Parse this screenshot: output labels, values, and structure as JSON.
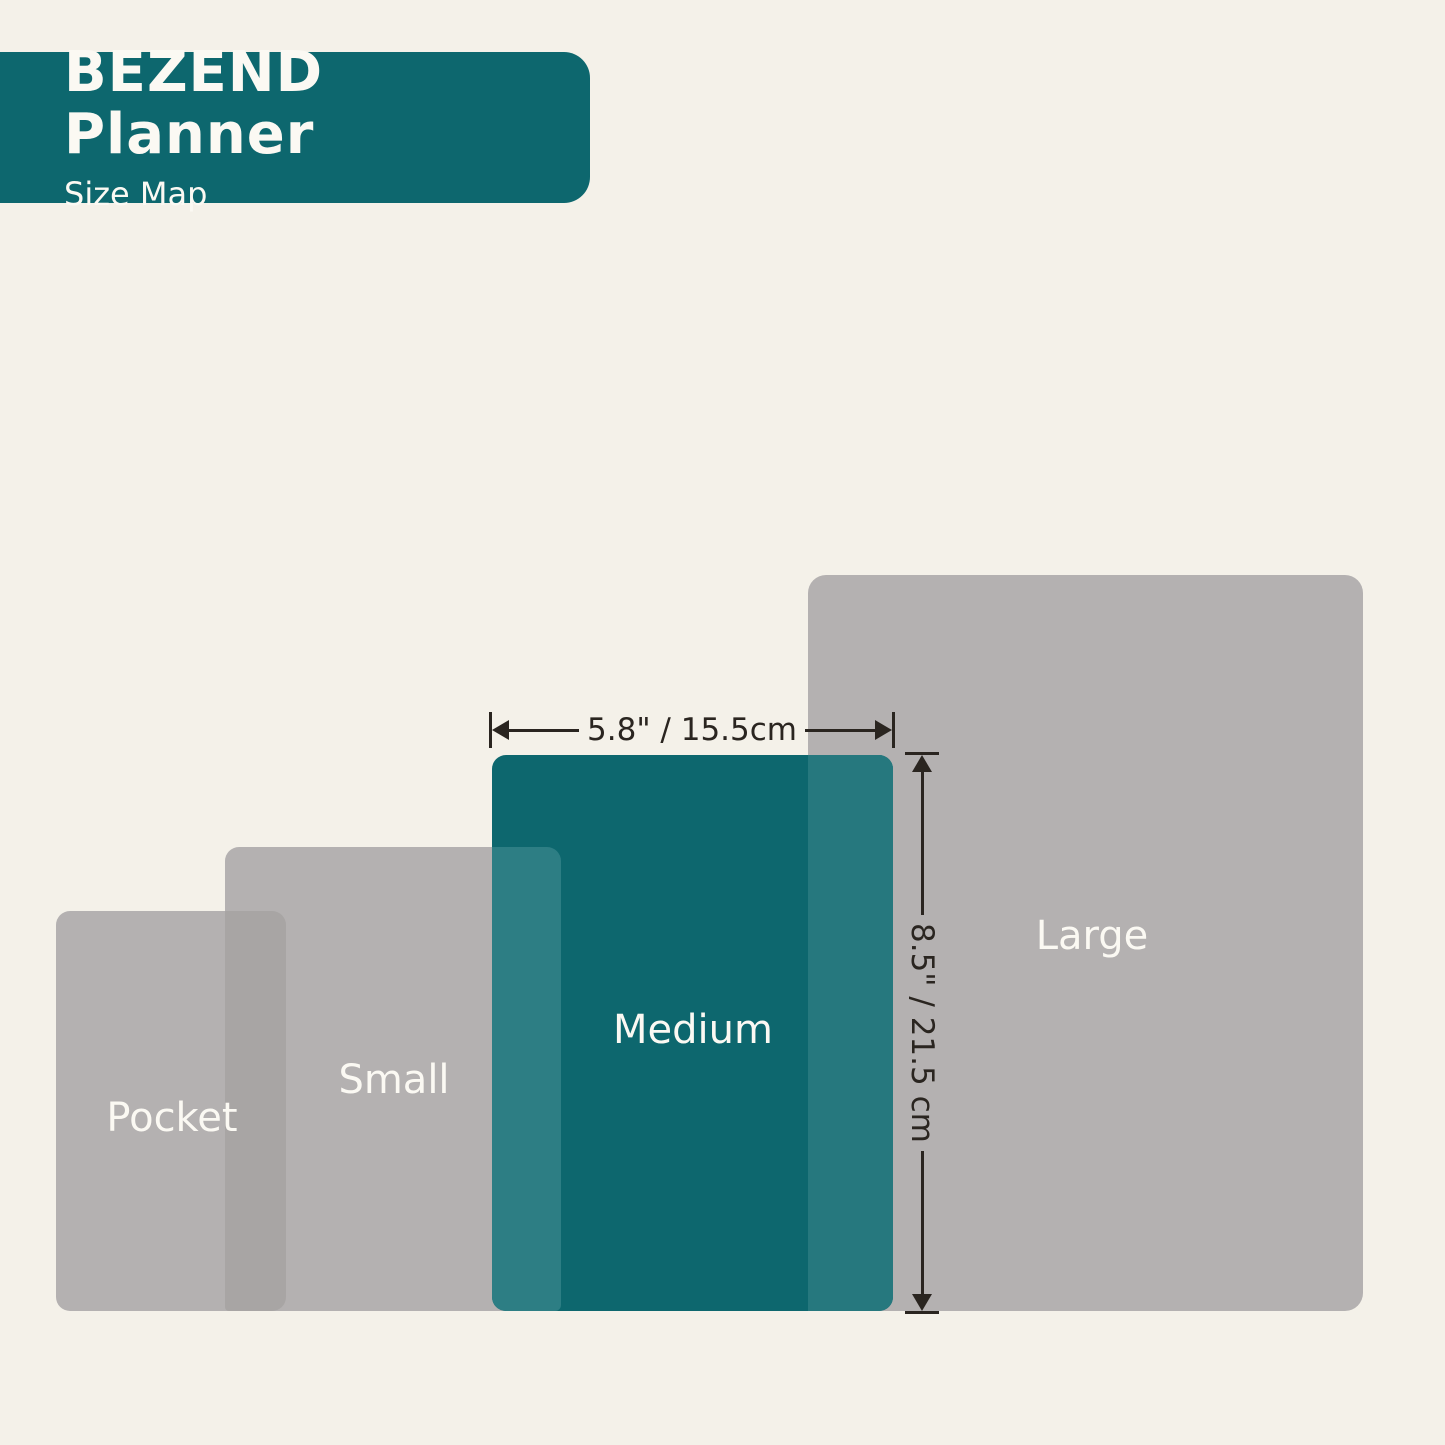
{
  "header": {
    "title": "BEZEND Planner",
    "subtitle": "Size Map"
  },
  "planner_sizes": {
    "pocket": {
      "label": "Pocket"
    },
    "small": {
      "label": "Small"
    },
    "medium": {
      "label": "Medium",
      "width_dimension": "5.8\" / 15.5cm",
      "height_dimension": "8.5\" / 21.5 cm",
      "highlighted": true
    },
    "large": {
      "label": "Large"
    }
  },
  "colors": {
    "accent_teal": "#0d676e",
    "overlap_teal_small": "#2d7e84",
    "overlap_teal_large": "#26787e",
    "rect_gray": "#b4b1b1",
    "overlap_gray": "#a8a5a4",
    "background_cream": "#f4f1e9",
    "dimension_ink": "#2a2520",
    "label_white": "#fbf9f3"
  }
}
